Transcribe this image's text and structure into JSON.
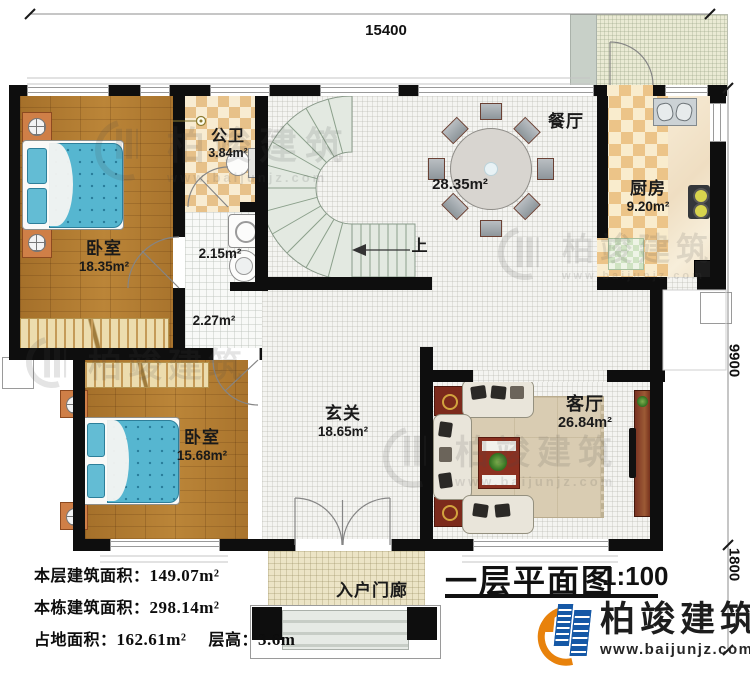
{
  "title": {
    "text": "一层平面图",
    "scale": "1:100"
  },
  "dimensions": {
    "top": "15400",
    "right_main": "9900",
    "right_porch": "1800"
  },
  "rooms": {
    "bedroom1": {
      "name": "卧室",
      "area": "18.35m²"
    },
    "bath": {
      "name": "公卫",
      "area": "3.84m²"
    },
    "laundry": {
      "area": "2.15m²"
    },
    "hall": {
      "area": "2.27m²"
    },
    "dining": {
      "name": "餐厅",
      "area": "28.35m²"
    },
    "kitchen": {
      "name": "厨房",
      "area": "9.20m²"
    },
    "bedroom2": {
      "name": "卧室",
      "area": "15.68m²"
    },
    "foyer": {
      "name": "玄关",
      "area": "18.65m²"
    },
    "living": {
      "name": "客厅",
      "area": "26.84m²"
    },
    "porch": {
      "name": "入户门廊"
    }
  },
  "stairs": {
    "direction_label": "上"
  },
  "stats": [
    {
      "label": "本层建筑面积：",
      "value": "149.07m²"
    },
    {
      "label": "本栋建筑面积：",
      "value": "298.14m²"
    },
    {
      "label": "占地面积：",
      "value": "162.61m²",
      "label2": "层高：",
      "value2": "3.6m"
    }
  ],
  "branding": {
    "company": "柏竣建筑",
    "website": "www.baijunjz.com"
  },
  "watermark": {
    "text": "柏竣建筑",
    "site": "www.baijunjz.com"
  },
  "colors": {
    "wall": "#0e0e0e",
    "brand_blue": "#1558a6",
    "brand_orange": "#e8820c",
    "wood_floor": "#b07c34",
    "bed_blue": "#56b6d0",
    "stair": "#e3e9e1",
    "bath_tile": "#e7c189",
    "kitchen_tile": "#ecc488",
    "porch_tile": "#ece4c6"
  }
}
